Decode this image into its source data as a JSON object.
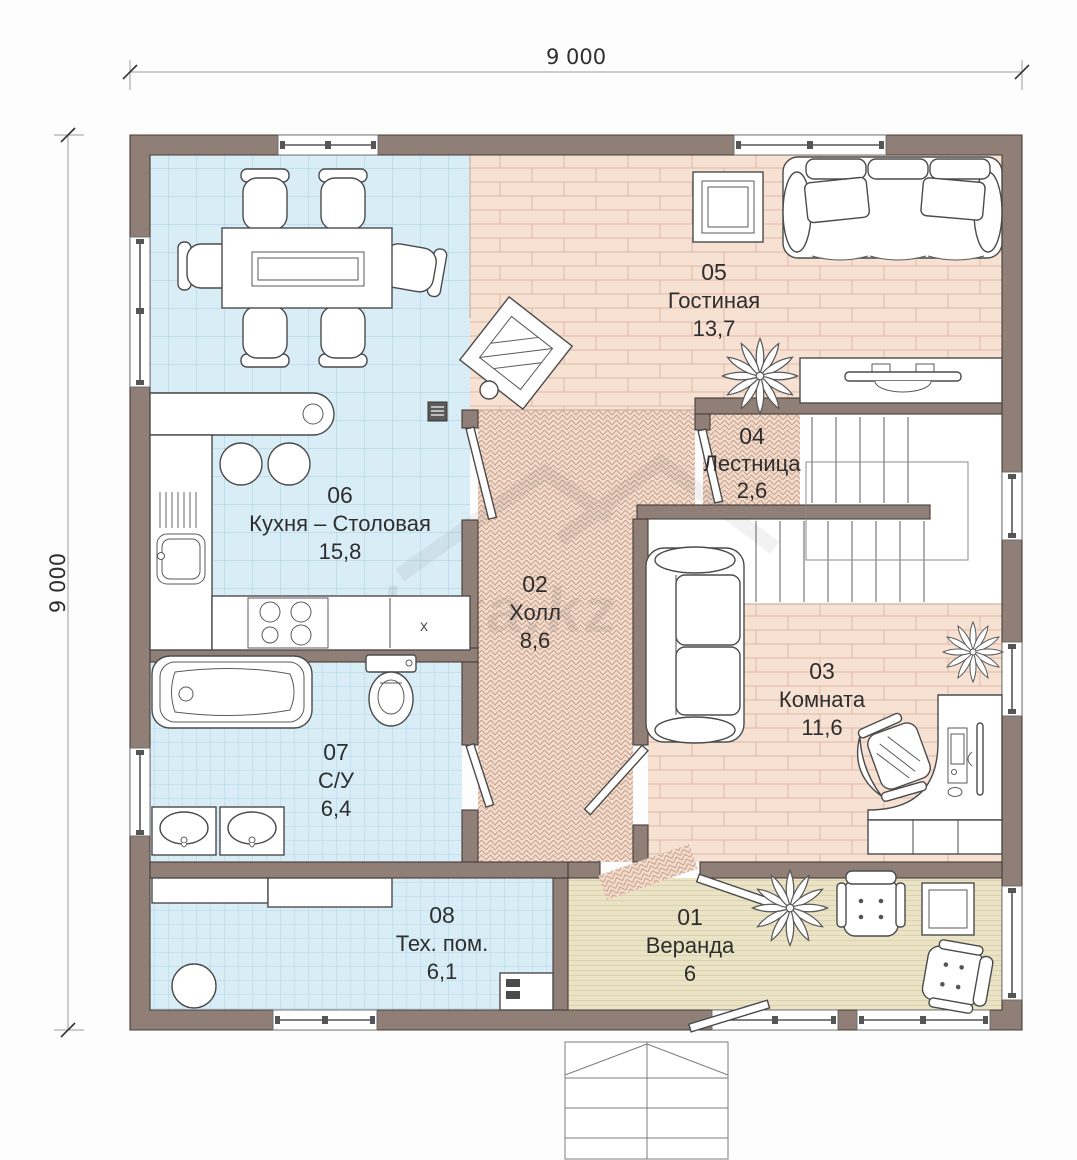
{
  "dimensions": {
    "top": "9 000",
    "left": "9 000"
  },
  "watermark": {
    "text": "hata.kz"
  },
  "rooms": [
    {
      "id": "01",
      "name": "Веранда",
      "area": "6"
    },
    {
      "id": "02",
      "name": "Холл",
      "area": "8,6"
    },
    {
      "id": "03",
      "name": "Комната",
      "area": "11,6"
    },
    {
      "id": "04",
      "name": "Лестница",
      "area": "2,6"
    },
    {
      "id": "05",
      "name": "Гостиная",
      "area": "13,7"
    },
    {
      "id": "06",
      "name": "Кухня – Столовая",
      "area": "15,8"
    },
    {
      "id": "07",
      "name": "С/У",
      "area": "6,4"
    },
    {
      "id": "08",
      "name": "Тех. пом.",
      "area": "6,1"
    }
  ],
  "annotations": {
    "cabinet_mark": "х"
  },
  "colors": {
    "wall": "#8f7f77",
    "wall_outline": "#463c37",
    "tile_floor": "#d9edf7",
    "tile_grid": "#a9cfe2",
    "wood_floor": "#f7e1d3",
    "wood_line": "#dcb9a5",
    "parquet_floor": "#f2dccd",
    "parquet_line": "#c99f8a",
    "deck_floor": "#eae3c6",
    "deck_line": "#c9bd96",
    "furniture_outline": "#4b4b4b",
    "label_text": "#2e2e2e"
  }
}
